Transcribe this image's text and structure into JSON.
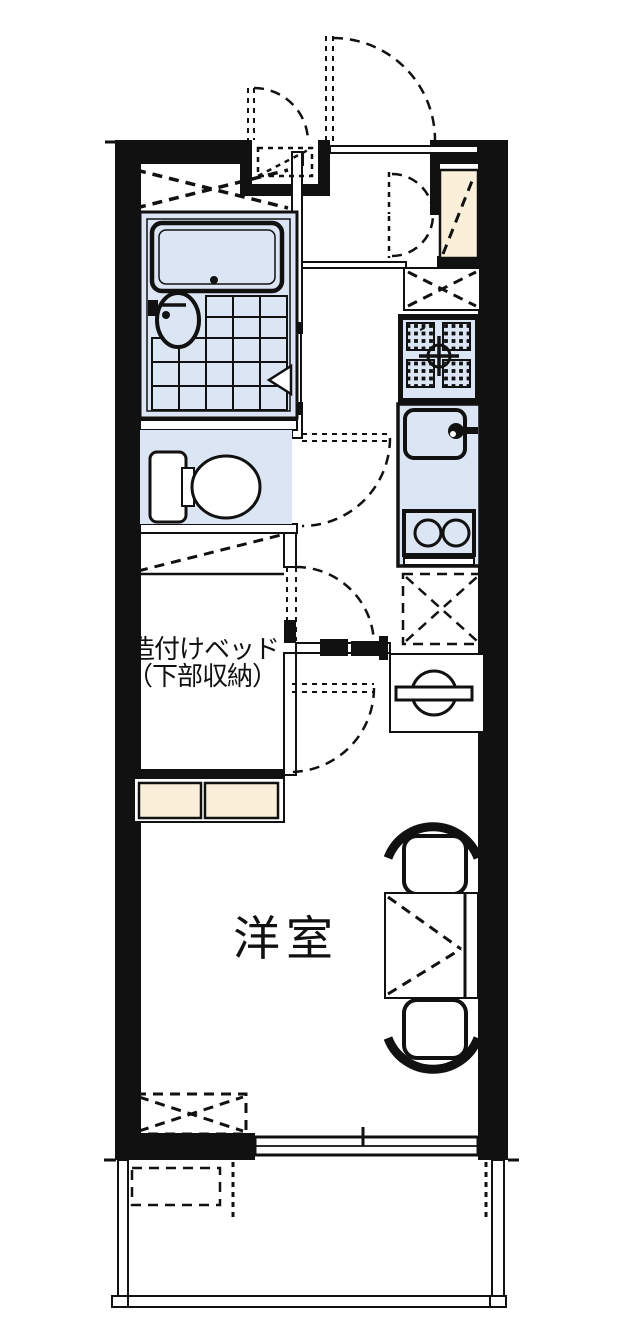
{
  "labels": {
    "bed_line1": "造付けベッド",
    "bed_line2": "（下部収納）",
    "room": "洋室"
  },
  "colors": {
    "line": "#111111",
    "water": "#dce5f3",
    "cream": "#faf0da",
    "background": "#ffffff"
  },
  "fixtures": [
    "bathtub",
    "bathroom-round-sink",
    "bathroom-tile-floor",
    "bathroom-folding-door",
    "overhead-shelf-dashed-x",
    "pipe-space-niche",
    "service-door",
    "entrance-door",
    "entrance-tataki",
    "entrance-closet-double-door",
    "refrigerator-space",
    "gas-stove",
    "kitchen-sink",
    "two-burner-unit",
    "storage-space-dashed-x",
    "washing-machine-space",
    "toilet",
    "toilet-door",
    "hall-room-doors",
    "built-in-bed",
    "bed-foot-storage",
    "dining-table",
    "chair-upper",
    "chair-lower",
    "equipment-space-dashed-x",
    "sliding-window",
    "balcony",
    "balcony-equipment-space"
  ]
}
